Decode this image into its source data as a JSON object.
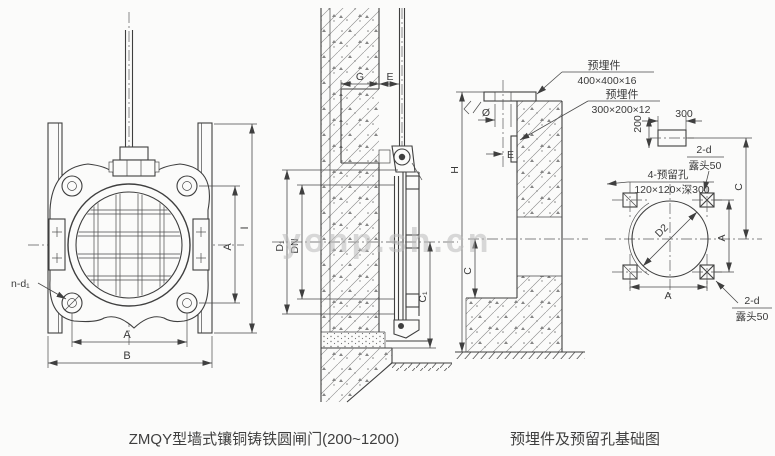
{
  "watermark": {
    "text": "yonp.sh.cn"
  },
  "captions": {
    "left": "ZMQY型墙式镶铜铸铁圆闸门(200~1200)",
    "right": "预埋件及预留孔基础图"
  },
  "front_view": {
    "bolt_count_label": "n-d₁",
    "dim_width_inner": "A",
    "dim_width_outer": "B",
    "dim_height_inner": "A",
    "dim_height_outer": "I"
  },
  "wall_section": {
    "dim_recess_width": "G",
    "dim_face_to_stem": "E",
    "dim_outer_dia": "D₁",
    "dim_nominal_dia": "DN",
    "dim_center_to_bottom": "C₁"
  },
  "embed_section": {
    "plate_top_label": "预埋件",
    "plate_top_size": "400×400×16",
    "plate_side_label": "预埋件",
    "plate_side_size": "300×200×12",
    "dim_stem_hole": "Ø",
    "dim_e": "E",
    "dim_total_height": "H",
    "dim_center_to_recess_bottom": "C"
  },
  "plan_view": {
    "dim_plate_width": "300",
    "dim_plate_offset": "200",
    "dim_hole_dia": "D2",
    "holes_label": "4-预留孔",
    "holes_size": "120×120×深300",
    "anchor_top_label": "2-d",
    "anchor_top_note": "露头50",
    "anchor_bottom_label": "2-d",
    "anchor_bottom_note": "露头50",
    "dim_center_to_plate": "C",
    "dim_hole_spacing_v": "A",
    "dim_hole_spacing_h": "A"
  }
}
